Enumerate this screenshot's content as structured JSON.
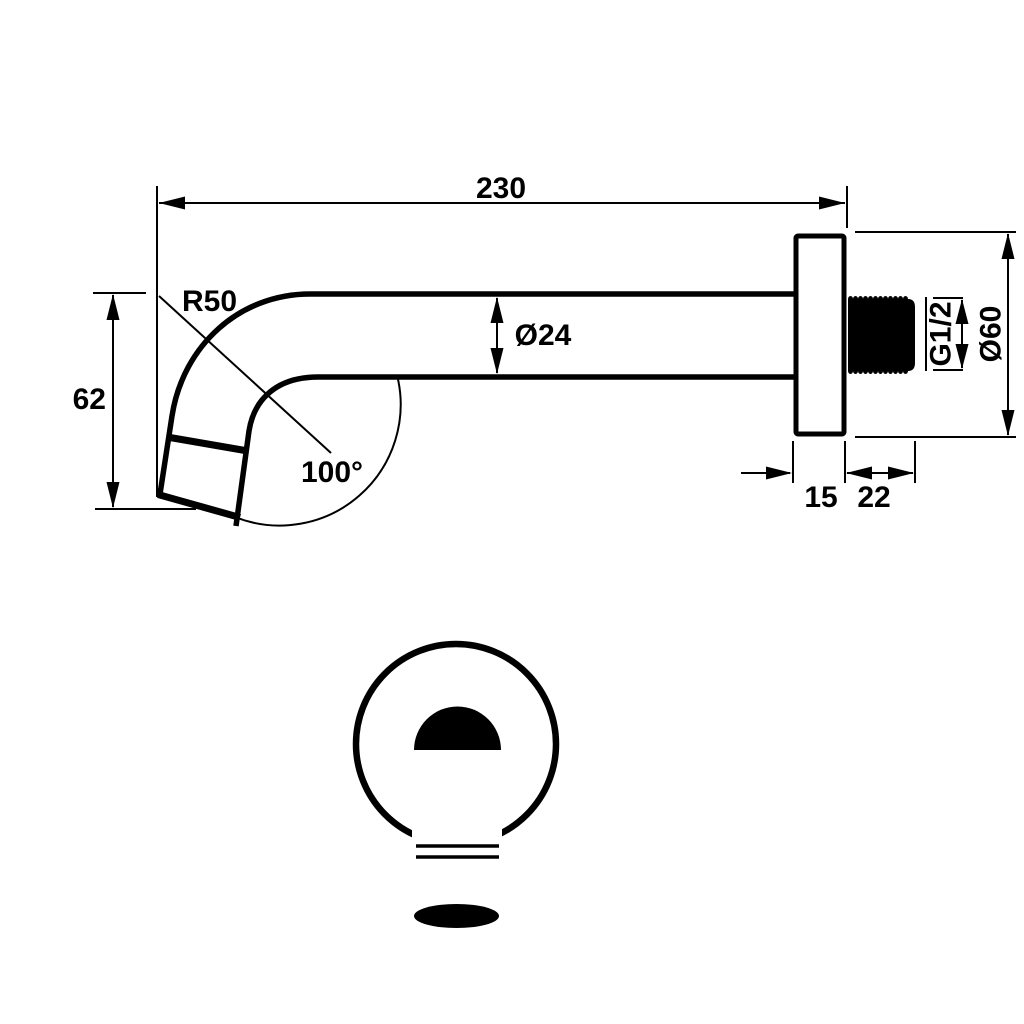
{
  "colors": {
    "ink": "#000000",
    "paper": "#ffffff"
  },
  "dimensions": {
    "length": "230",
    "bend_radius": "R50",
    "pipe_diameter": "Ø24",
    "drop_height": "62",
    "bend_angle": "100°",
    "flange_depth": "15",
    "thread_length": "22",
    "thread_size": "G1/2",
    "flange_diameter": "Ø60"
  }
}
